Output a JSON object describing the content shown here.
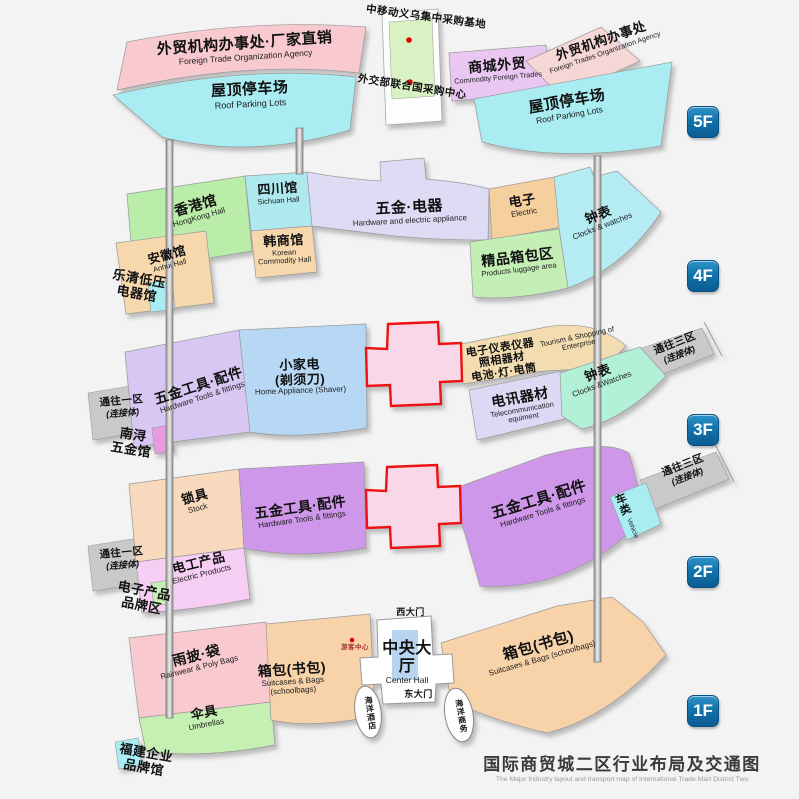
{
  "title": {
    "zh": "国际商贸城二区行业布局及交通图",
    "en": "The Major Industry layout and transport map of International Trade Mart District Two"
  },
  "colors": {
    "badge_blue": "#0f6ba3",
    "cross_red": "#ee1111",
    "marker_red": "#e60000",
    "link_gray": "#c9c9c9"
  },
  "f5": {
    "badge": "5F",
    "agency_left": {
      "zh": "外贸机构办事处·厂家直销",
      "en": "Foreign Trade Organization Agency"
    },
    "roof_parking": {
      "zh": "屋顶停车场",
      "en": "Roof Parking Lots"
    },
    "mobile_base": {
      "zh": "中移动义乌集中采购基地"
    },
    "un_center": {
      "zh": "外交部联合国采购中心"
    },
    "commodity": {
      "zh": "商城外贸",
      "en": "Commodity Foreign Trades"
    },
    "agency_right": {
      "zh": "外贸机构办事处",
      "en": "Foreign Trades Organization Agency"
    }
  },
  "f4": {
    "badge": "4F",
    "hongkong": {
      "zh": "香港馆",
      "en": "HongKong Hall"
    },
    "sichuan": {
      "zh": "四川馆",
      "en": "Sichuan Hall"
    },
    "anhui": {
      "zh": "安徽馆",
      "en": "Anhui Hall"
    },
    "korean": {
      "zh": "韩商馆",
      "en": "Korean Commodity Hall"
    },
    "hardware_electric": {
      "zh": "五金·电器",
      "en": "Hardware and electric appliance"
    },
    "electric": {
      "zh": "电子",
      "en": "Electric"
    },
    "clocks": {
      "zh": "钟表",
      "en": "Clocks & watches"
    },
    "luggage": {
      "zh": "精品箱包区",
      "en": "Products luggage area"
    },
    "yueqing": {
      "line1": "乐清低压",
      "line2": "电器馆"
    }
  },
  "f3": {
    "badge": "3F",
    "tools": {
      "zh": "五金工具·配件",
      "en": "Hardware Tools & fittings"
    },
    "home_appliance": {
      "zh1": "小家电",
      "zh2": "(剃须刀)",
      "en": "Home Appliance (Shaver)"
    },
    "instruments": {
      "line1": "电子仪表仪器",
      "line2": "照相器材",
      "line3": "电池·灯·电筒"
    },
    "tourism": {
      "en": "Tourism & Shopping of Enterprise"
    },
    "telecom": {
      "zh": "电讯器材",
      "en": "Telecommunication equiment"
    },
    "clocks": {
      "zh": "钟表",
      "en": "Clocks &Watches"
    },
    "link_east": {
      "zh": "通往三区",
      "sub": "(连接体)"
    },
    "link_west": {
      "zh": "通往一区",
      "sub": "(连接体)"
    },
    "nanxun": {
      "line1": "南浔",
      "line2": "五金馆"
    }
  },
  "f2": {
    "badge": "2F",
    "lock": {
      "zh": "锁具",
      "en": "Stock"
    },
    "electric_products": {
      "zh": "电工产品",
      "en": "Electric Products"
    },
    "tools": {
      "zh": "五金工具·配件",
      "en": "Hardware Tools & fittings"
    },
    "vehicle": {
      "zh": "车类",
      "en": "Vehicle"
    },
    "link_east": {
      "zh": "通往三区",
      "sub": "(连接体)"
    },
    "link_west": {
      "zh": "通往一区",
      "sub": "(连接体)"
    },
    "brand": {
      "line1": "电子产品",
      "line2": "品牌区"
    }
  },
  "f1": {
    "badge": "1F",
    "raincoat": {
      "zh": "雨披·袋",
      "en": "Rainwear & Poly Bags"
    },
    "umbrella": {
      "zh": "伞具",
      "en": "Umbrellas"
    },
    "bags": {
      "zh": "箱包(书包)",
      "en": "Suitcases & Bags (schoolbags)"
    },
    "visitor_center": {
      "zh": "游客中心"
    },
    "center_hall": {
      "zh": "中央大厅",
      "en": "Center Hall"
    },
    "west_gate": {
      "zh": "西大门"
    },
    "east_gate": {
      "zh": "东大门"
    },
    "hotel": {
      "zh": "海洋酒店"
    },
    "business": {
      "zh": "海洋商务"
    },
    "fujian": {
      "line1": "福建企业",
      "line2": "品牌馆"
    }
  }
}
